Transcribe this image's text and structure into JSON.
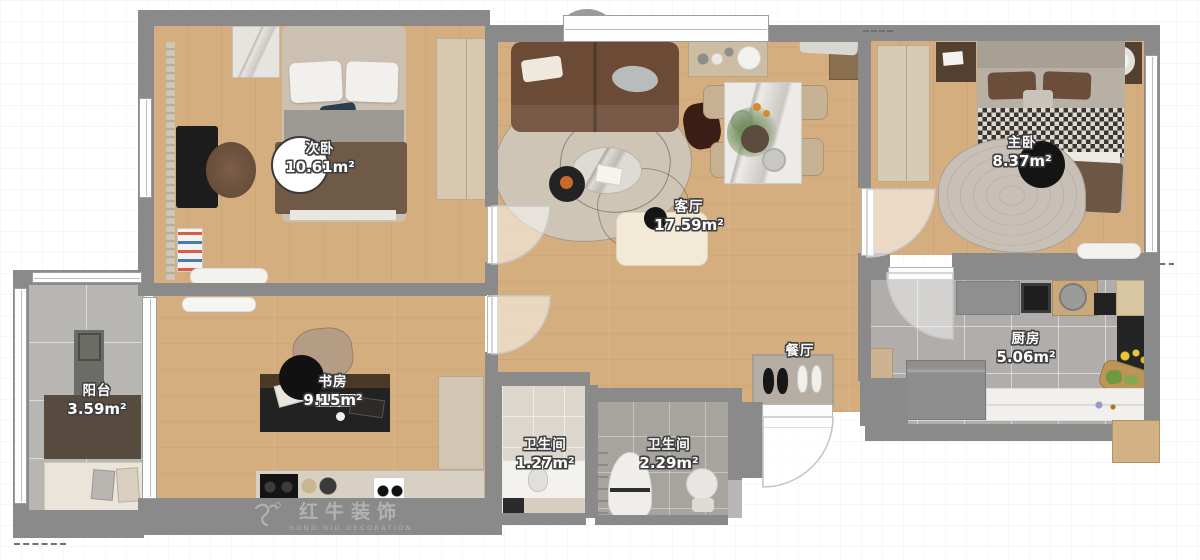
{
  "plan": {
    "watermark": {
      "brand": "红牛装饰",
      "tagline": "HONG NIU DECORATION"
    },
    "rooms": [
      {
        "key": "secondary-bedroom",
        "name": "次卧",
        "area": "10.61m²"
      },
      {
        "key": "living-room",
        "name": "客厅",
        "area": "17.59m²"
      },
      {
        "key": "master-bedroom",
        "name": "主卧",
        "area": "8.37m²"
      },
      {
        "key": "kitchen",
        "name": "厨房",
        "area": "5.06m²"
      },
      {
        "key": "balcony",
        "name": "阳台",
        "area": "3.59m²"
      },
      {
        "key": "study",
        "name": "书房",
        "area": "9.15m²"
      },
      {
        "key": "bathroom-small",
        "name": "卫生间",
        "area": "1.27m²"
      },
      {
        "key": "bathroom-large",
        "name": "卫生间",
        "area": "2.29m²"
      },
      {
        "key": "dining",
        "name": "餐厅",
        "area": ""
      }
    ],
    "colors": {
      "wall": "#8a8a8a",
      "wood_floor": "#d5ae80",
      "grey_tile": "#b0adaa",
      "light_tile": "#dcd6cd",
      "watermark_grey": "#b2b2b0",
      "label_fill": "#ffffff",
      "label_outline": "#3f3f3f"
    }
  }
}
